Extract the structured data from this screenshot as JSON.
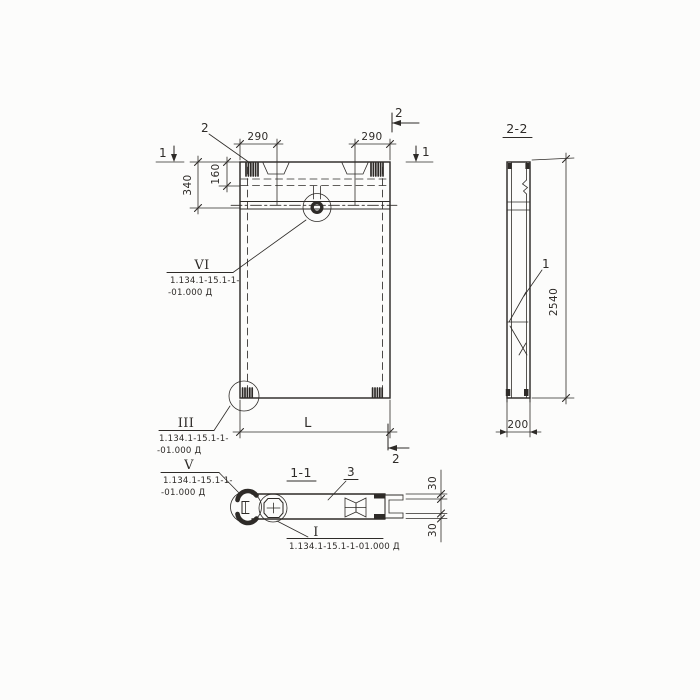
{
  "meta": {
    "kind": "construction panel working drawing",
    "language": "ru"
  },
  "colors": {
    "ink": "#2e2b28",
    "paper": "#fcfcfb"
  },
  "labels": {
    "detail_2": "2",
    "cut1_left": "1",
    "cut1_right": "1",
    "cut2_top": "2",
    "cut2_bottom": "2",
    "dim_290_left": "290",
    "dim_290_right": "290",
    "dim_340": "340",
    "dim_160": "160",
    "dim_L": "L",
    "side_title": "2-2",
    "side_part": "1",
    "dim_2540": "2540",
    "dim_200": "200",
    "bottom_title": "1-1",
    "bottom_part": "3",
    "dim_30_top": "30",
    "dim_30_bottom": "30"
  },
  "callouts": {
    "vi": {
      "numeral": "VI",
      "line1": "1.134.1-15.1-1-",
      "line2": "-01.000 Д"
    },
    "iii": {
      "numeral": "III",
      "line1": "1.134.1-15.1-1-",
      "line2": "-01.000 Д"
    },
    "v": {
      "numeral": "V",
      "line1": "1.134.1-15.1-1-",
      "line2": "-01.000 Д"
    },
    "i": {
      "numeral": "I",
      "line1": "1.134.1-15.1-1-01.000 Д"
    }
  }
}
